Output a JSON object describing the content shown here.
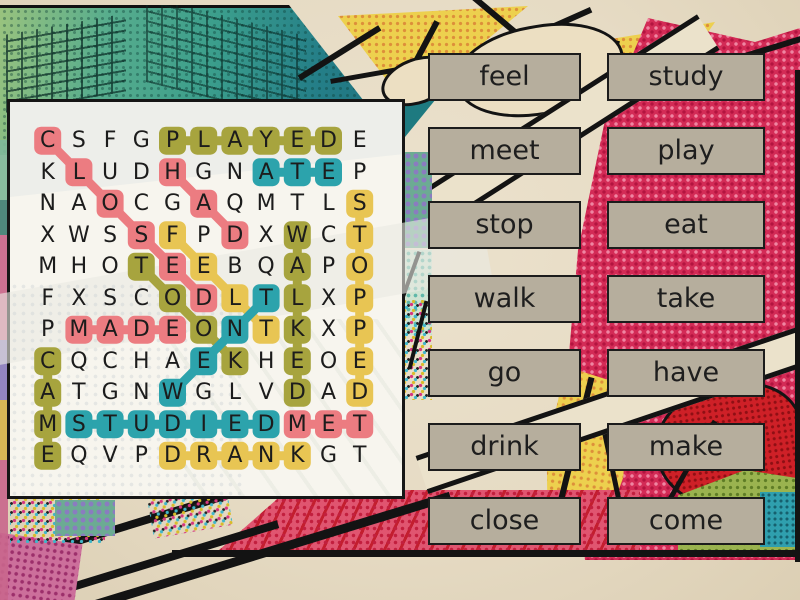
{
  "grid": {
    "rows": [
      "CSFGPLAYEDE",
      "KLUDHGNATEP",
      "NAOCGAQMTLS",
      "XWSSFPDXWCT",
      "MHOTEEBQAPO",
      "FXSCODLTLXP",
      "PMADEONTKXP",
      "CQCHAEKHEOE",
      "ATGNWGLVDAD",
      "MSTUDIEDMET",
      "EQVPDRANKGT"
    ],
    "highlights": [
      {
        "word": "PLAYED",
        "color": "olive",
        "row": 0,
        "col": 4,
        "drow": 0,
        "dcol": 1,
        "len": 6
      },
      {
        "word": "STOPPED",
        "color": "yellow",
        "row": 2,
        "col": 10,
        "drow": 1,
        "dcol": 0,
        "len": 7
      },
      {
        "word": "WALKED",
        "color": "olive",
        "row": 3,
        "col": 8,
        "drow": 1,
        "dcol": 0,
        "len": 6
      },
      {
        "word": "TOOK",
        "color": "olive",
        "row": 4,
        "col": 3,
        "drow": 1,
        "dcol": 1,
        "len": 4
      },
      {
        "word": "CAME",
        "color": "olive",
        "row": 7,
        "col": 0,
        "drow": 1,
        "dcol": 0,
        "len": 4
      },
      {
        "word": "DRANK",
        "color": "yellow",
        "row": 10,
        "col": 4,
        "drow": 0,
        "dcol": 1,
        "len": 5
      },
      {
        "word": "FELT",
        "color": "yellow",
        "row": 3,
        "col": 4,
        "drow": 1,
        "dcol": 1,
        "len": 4
      },
      {
        "word": "CLOSED",
        "color": "pink",
        "row": 0,
        "col": 0,
        "drow": 1,
        "dcol": 1,
        "len": 6
      },
      {
        "word": "HAD",
        "color": "pink",
        "row": 1,
        "col": 4,
        "drow": 1,
        "dcol": 1,
        "len": 3
      },
      {
        "word": "MADE",
        "color": "pink",
        "row": 6,
        "col": 1,
        "drow": 0,
        "dcol": 1,
        "len": 4
      },
      {
        "word": "MET",
        "color": "pink",
        "row": 9,
        "col": 8,
        "drow": 0,
        "dcol": 1,
        "len": 3
      },
      {
        "word": "ATE",
        "color": "teal",
        "row": 1,
        "col": 7,
        "drow": 0,
        "dcol": 1,
        "len": 3
      },
      {
        "word": "WENT",
        "color": "teal",
        "row": 8,
        "col": 4,
        "drow": -1,
        "dcol": 1,
        "len": 4
      },
      {
        "word": "STUDIED",
        "color": "teal",
        "row": 9,
        "col": 1,
        "drow": 0,
        "dcol": 1,
        "len": 7
      }
    ]
  },
  "colors": {
    "pink": "#ec7c81",
    "olive": "#a7a43e",
    "teal": "#2ca3ac",
    "yellow": "#e8c553",
    "letter": "#1c1c1c",
    "button_bg": "#b6ae9d",
    "button_border": "#1c1c1c"
  },
  "word_buttons": {
    "column1": [
      "feel",
      "meet",
      "stop",
      "walk",
      "go",
      "drink",
      "close"
    ],
    "column2": [
      "study",
      "play",
      "eat",
      "take",
      "have",
      "make",
      "come"
    ]
  }
}
